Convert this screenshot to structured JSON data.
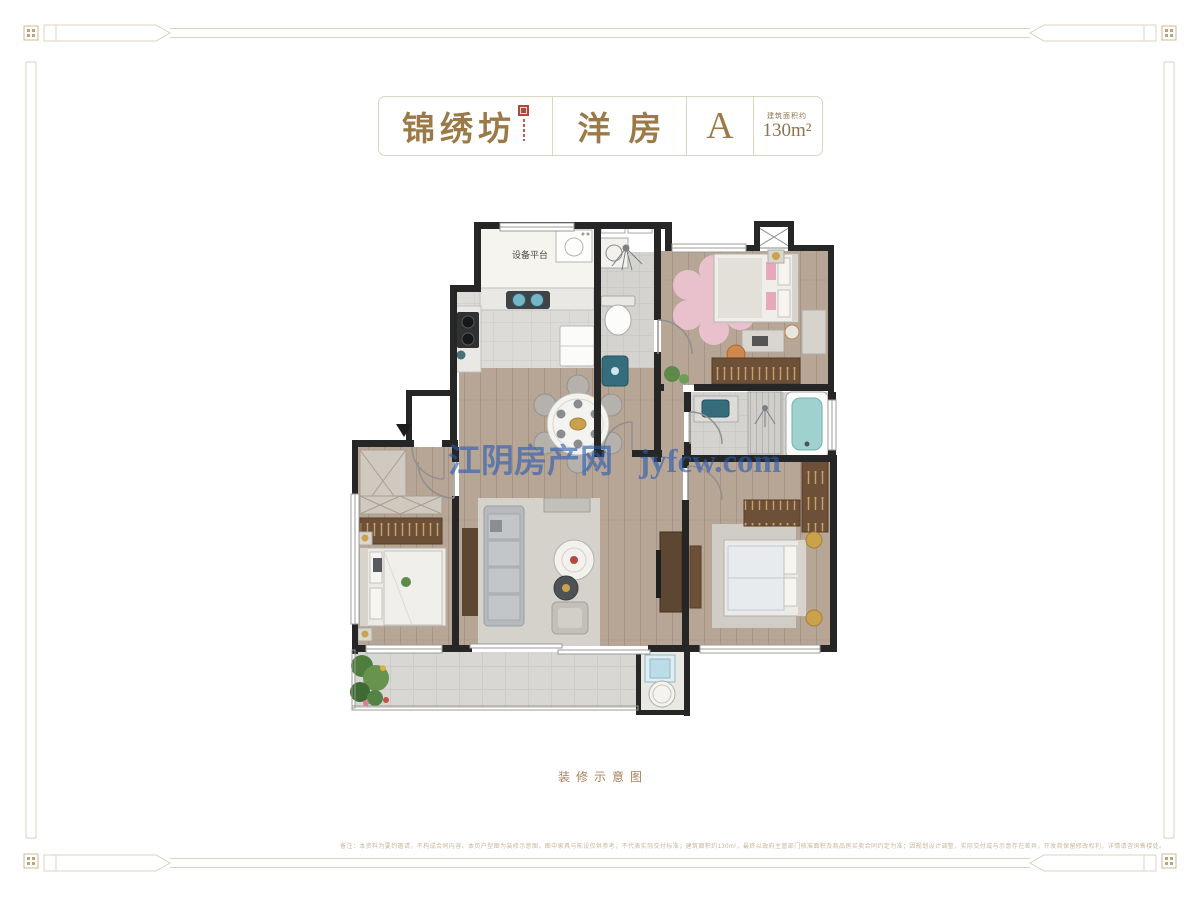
{
  "header": {
    "project_name": "锦绣坊",
    "product_type": "洋房",
    "unit_label": "A",
    "area_label": "建筑面积约",
    "area_value": "130m²"
  },
  "floorplan": {
    "equipment_platform_label": "设备平台"
  },
  "watermark": {
    "site_name": "江阴房产网",
    "site_url": "jyfcw.com"
  },
  "footer": {
    "caption": "装修示意图",
    "disclaimer": "备注：本资料为要约邀请，不构成合同内容。本页户型图为装修示意图，图中家具与陈设仅供参考，不代表实际交付标准；建筑面积约130m²，最终以政府主管部门核准面积及商品房买卖合同约定为准；因规划设计调整，实际交付或与示意存在差异，开发商保留修改权利，详情请咨询售楼处。"
  },
  "colors": {
    "title_gold": "#9b7a47",
    "seal_red": "#b3473c",
    "wall": "#262626",
    "wood_floor": "#b7a595",
    "tile_floor": "#dcdbd7",
    "teal_fixture": "#3f7d8e",
    "pink_rug": "#ebc3d0",
    "wardrobe_brown": "#6d5038",
    "gold_accent": "#c9a24b",
    "watermark_blue": "#2f66b4",
    "border_tan": "#dbd2c1"
  }
}
